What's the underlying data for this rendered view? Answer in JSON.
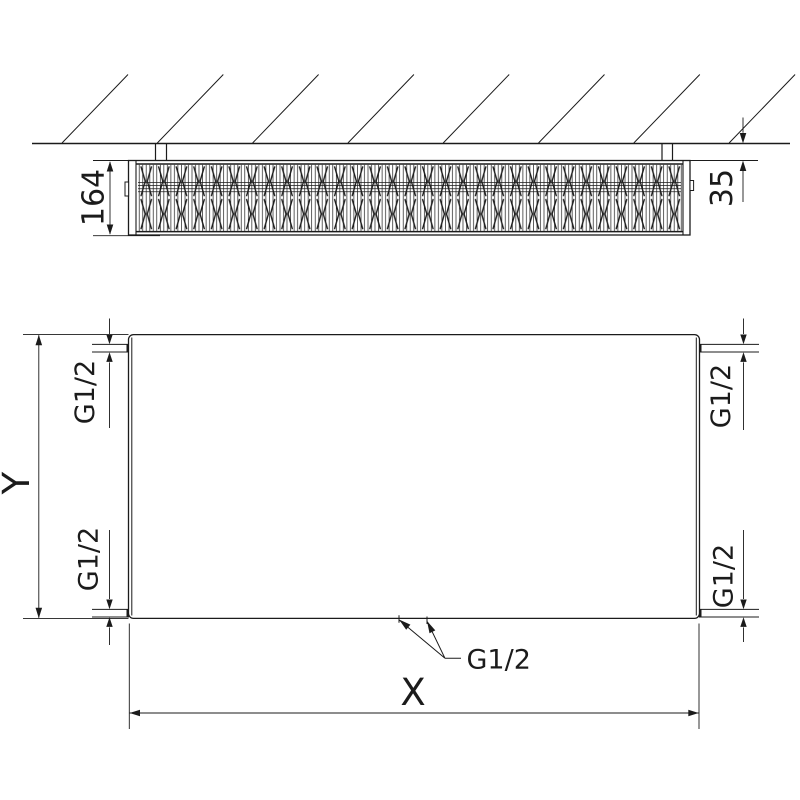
{
  "drawing": {
    "top_view": {
      "depth_label": "164",
      "wall_gap_label": "35"
    },
    "front_view": {
      "height_label": "Y",
      "width_label": "X",
      "port_top_left": "G1/2",
      "port_top_right": "G1/2",
      "port_bottom_left": "G1/2",
      "port_bottom_right": "G1/2",
      "port_bottom_center": "G1/2"
    },
    "colors": {
      "line": "#1b1b1b",
      "background": "#ffffff"
    }
  }
}
